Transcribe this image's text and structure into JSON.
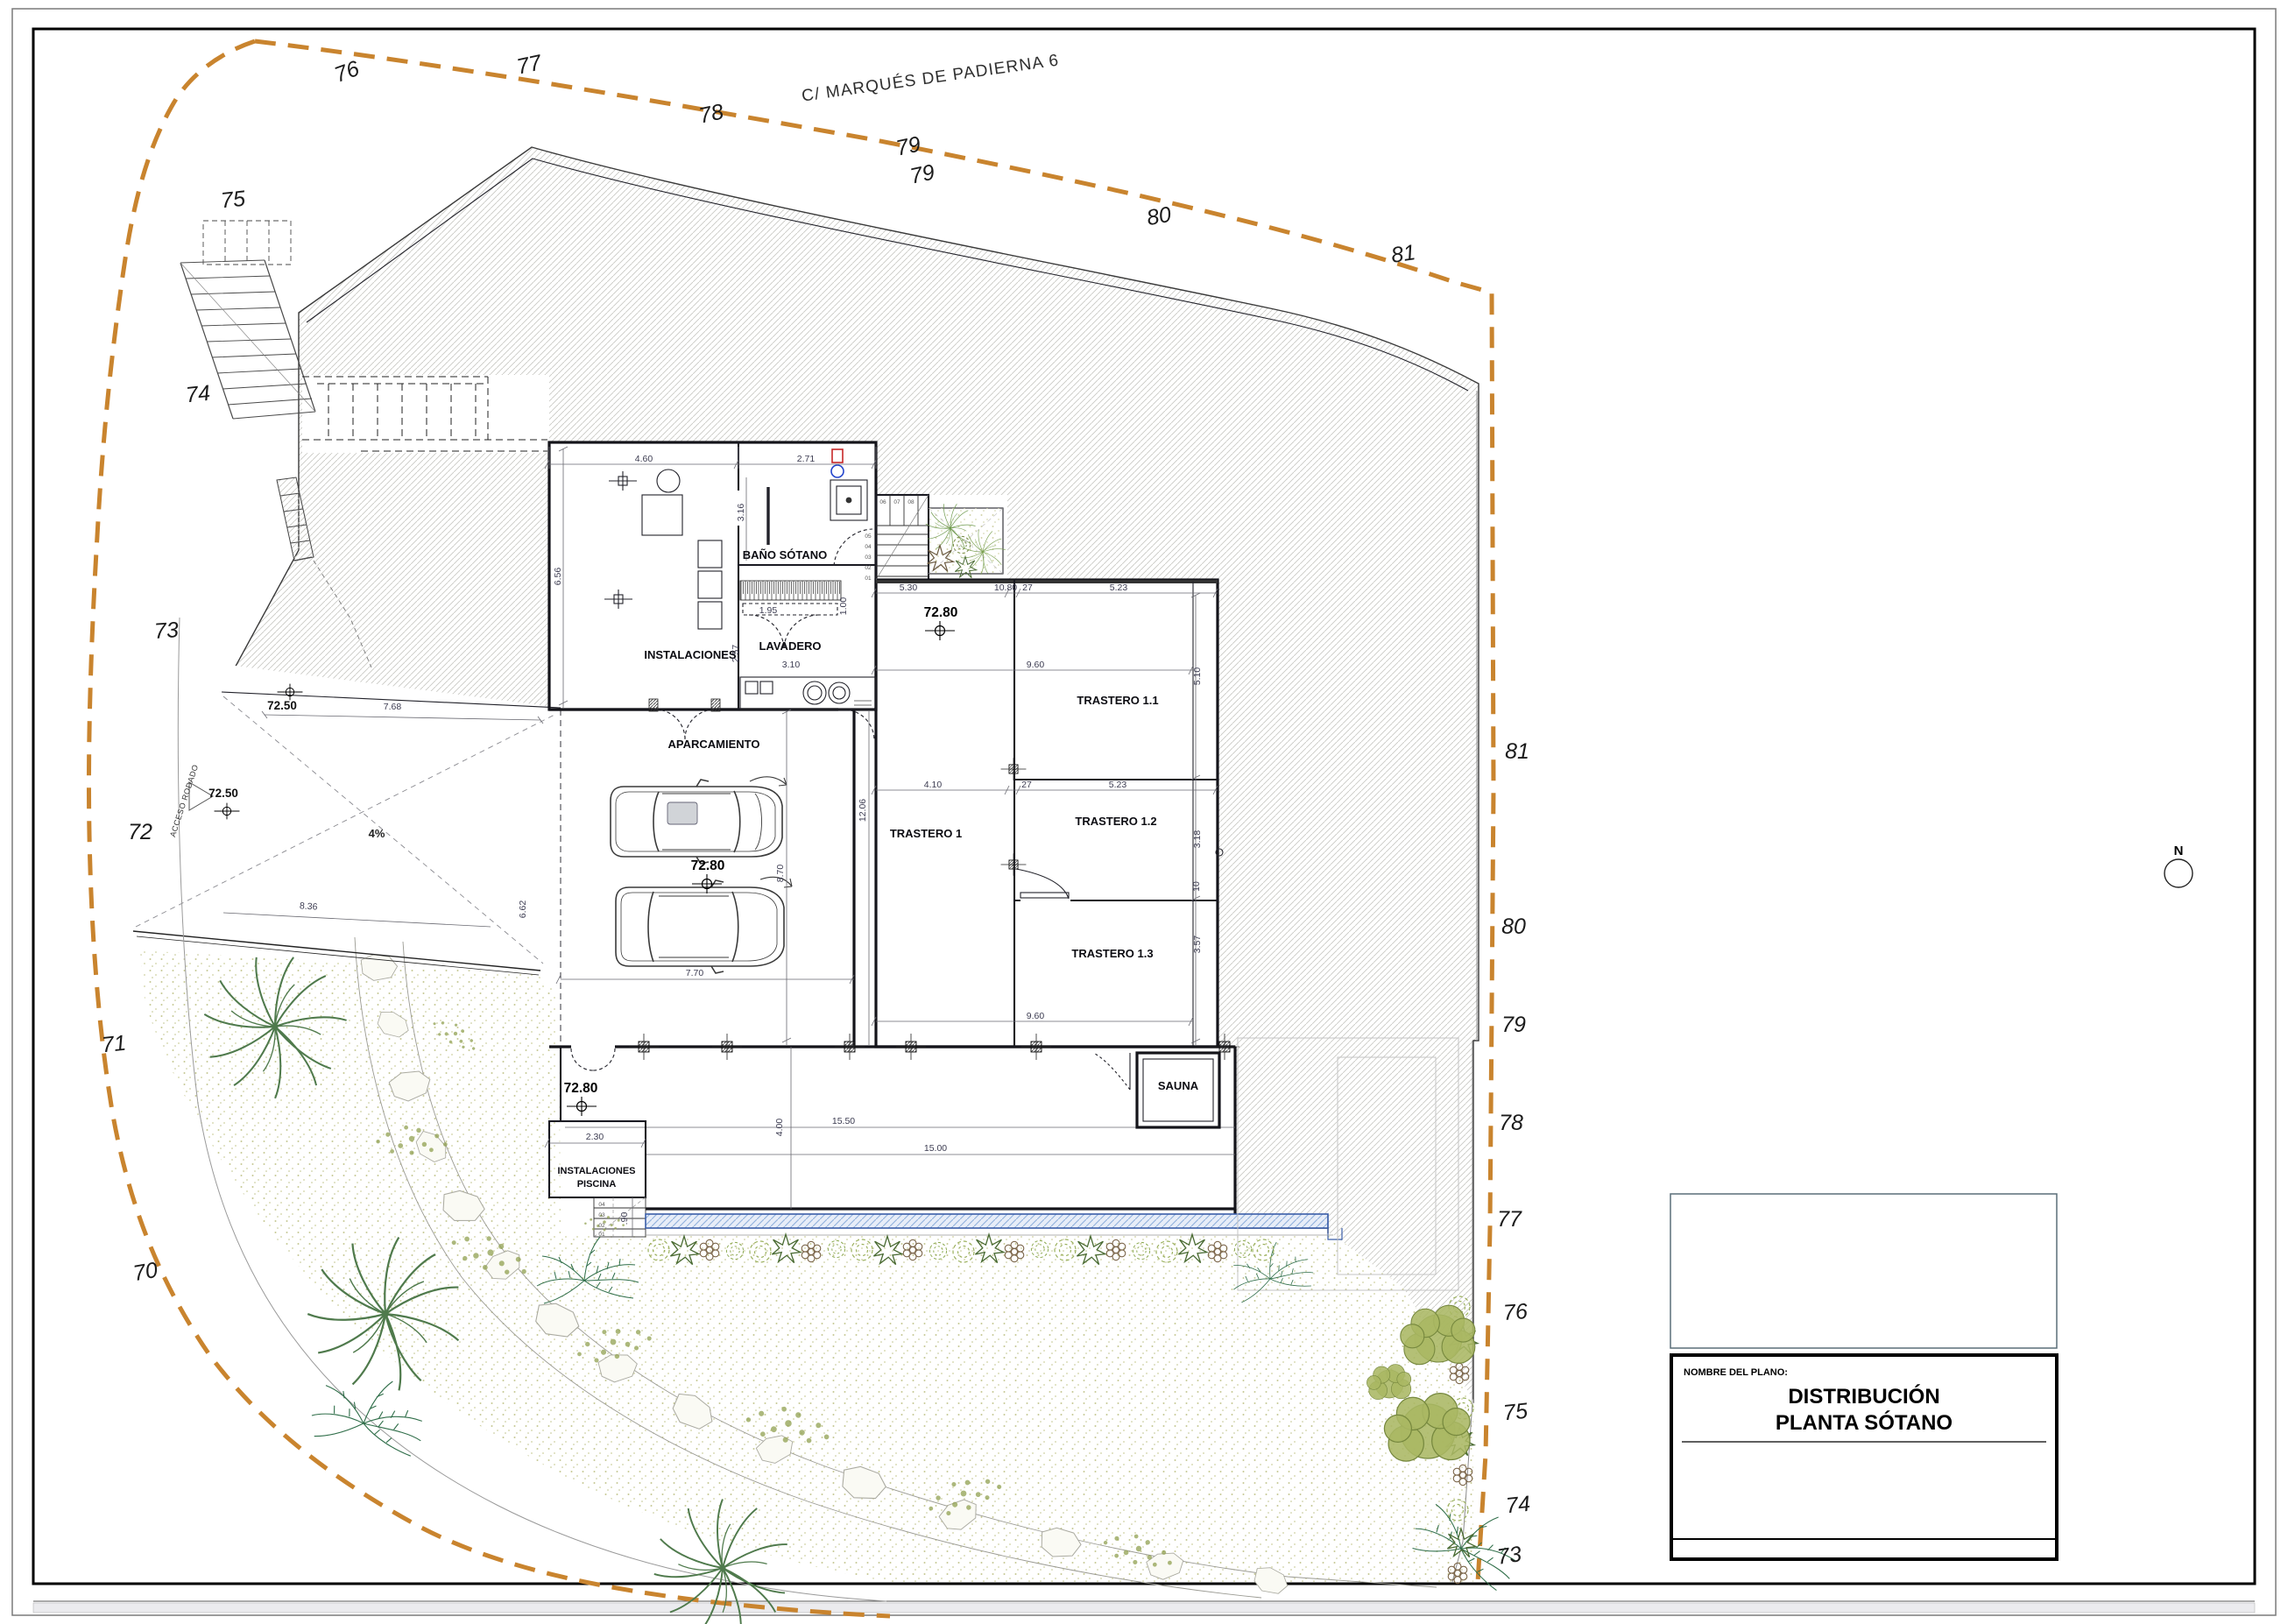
{
  "document": {
    "street_label": "C/ MARQUÉS DE PADIERNA 6",
    "north_label": "N",
    "slope_label": "4%",
    "access_road_label": "ACCESO RODADO"
  },
  "contours": {
    "top": [
      "76",
      "77",
      "78",
      "79",
      "79",
      "80",
      "81"
    ],
    "left": [
      "75",
      "74",
      "73",
      "72",
      "71",
      "70"
    ],
    "right": [
      "81",
      "80",
      "79",
      "78",
      "77",
      "76",
      "75",
      "74",
      "73"
    ]
  },
  "rooms": {
    "instalaciones": "INSTALACIONES",
    "bano_sotano": "BAÑO SÓTANO",
    "lavadero": "LAVADERO",
    "aparcamiento": "APARCAMIENTO",
    "trastero_1": "TRASTERO 1",
    "trastero_1_1": "TRASTERO 1.1",
    "trastero_1_2": "TRASTERO 1.2",
    "trastero_1_3": "TRASTERO 1.3",
    "sauna": "SAUNA",
    "instalaciones_piscina_1": "INSTALACIONES",
    "instalaciones_piscina_2": "PISCINA"
  },
  "levels": {
    "garage": "72.80",
    "ramp": "72.50"
  },
  "dimensions": {
    "d_4_60": "4.60",
    "d_2_71": "2.71",
    "d_3_16": "3.16",
    "d_6_56": "6.56",
    "d_1_95": "1.95",
    "d_2_57": "2.57",
    "d_3_10": "3.10",
    "d_1_00": "1.00",
    "d_5_30": "5.30",
    "d_10_80": "10.80",
    "d_27": "27",
    "d_5_23": "5.23",
    "d_9_60": "9.60",
    "d_5_10": "5.10",
    "d_4_10": "4.10",
    "d_3_18": "3.18",
    "d_10": "10",
    "d_3_57": "3.57",
    "d_12_06": "12.06",
    "d_8_70": "8.70",
    "d_7_70": "7.70",
    "d_2_30": "2.30",
    "d_15_50": "15.50",
    "d_15_00": "15.00",
    "d_4_00": "4.00",
    "d_90": ".90",
    "d_7_68": "7.68",
    "d_8_36": "8.36",
    "d_6_62": "6.62"
  },
  "stairs": {
    "main": [
      "01",
      "02",
      "03",
      "04",
      "05",
      "06",
      "07",
      "08"
    ],
    "piscina": [
      "01",
      "02",
      "03",
      "04"
    ]
  },
  "title_block": {
    "field_label": "NOMBRE DEL PLANO:",
    "title_line1": "DISTRIBUCIÓN",
    "title_line2": "PLANTA SÓTANO"
  }
}
